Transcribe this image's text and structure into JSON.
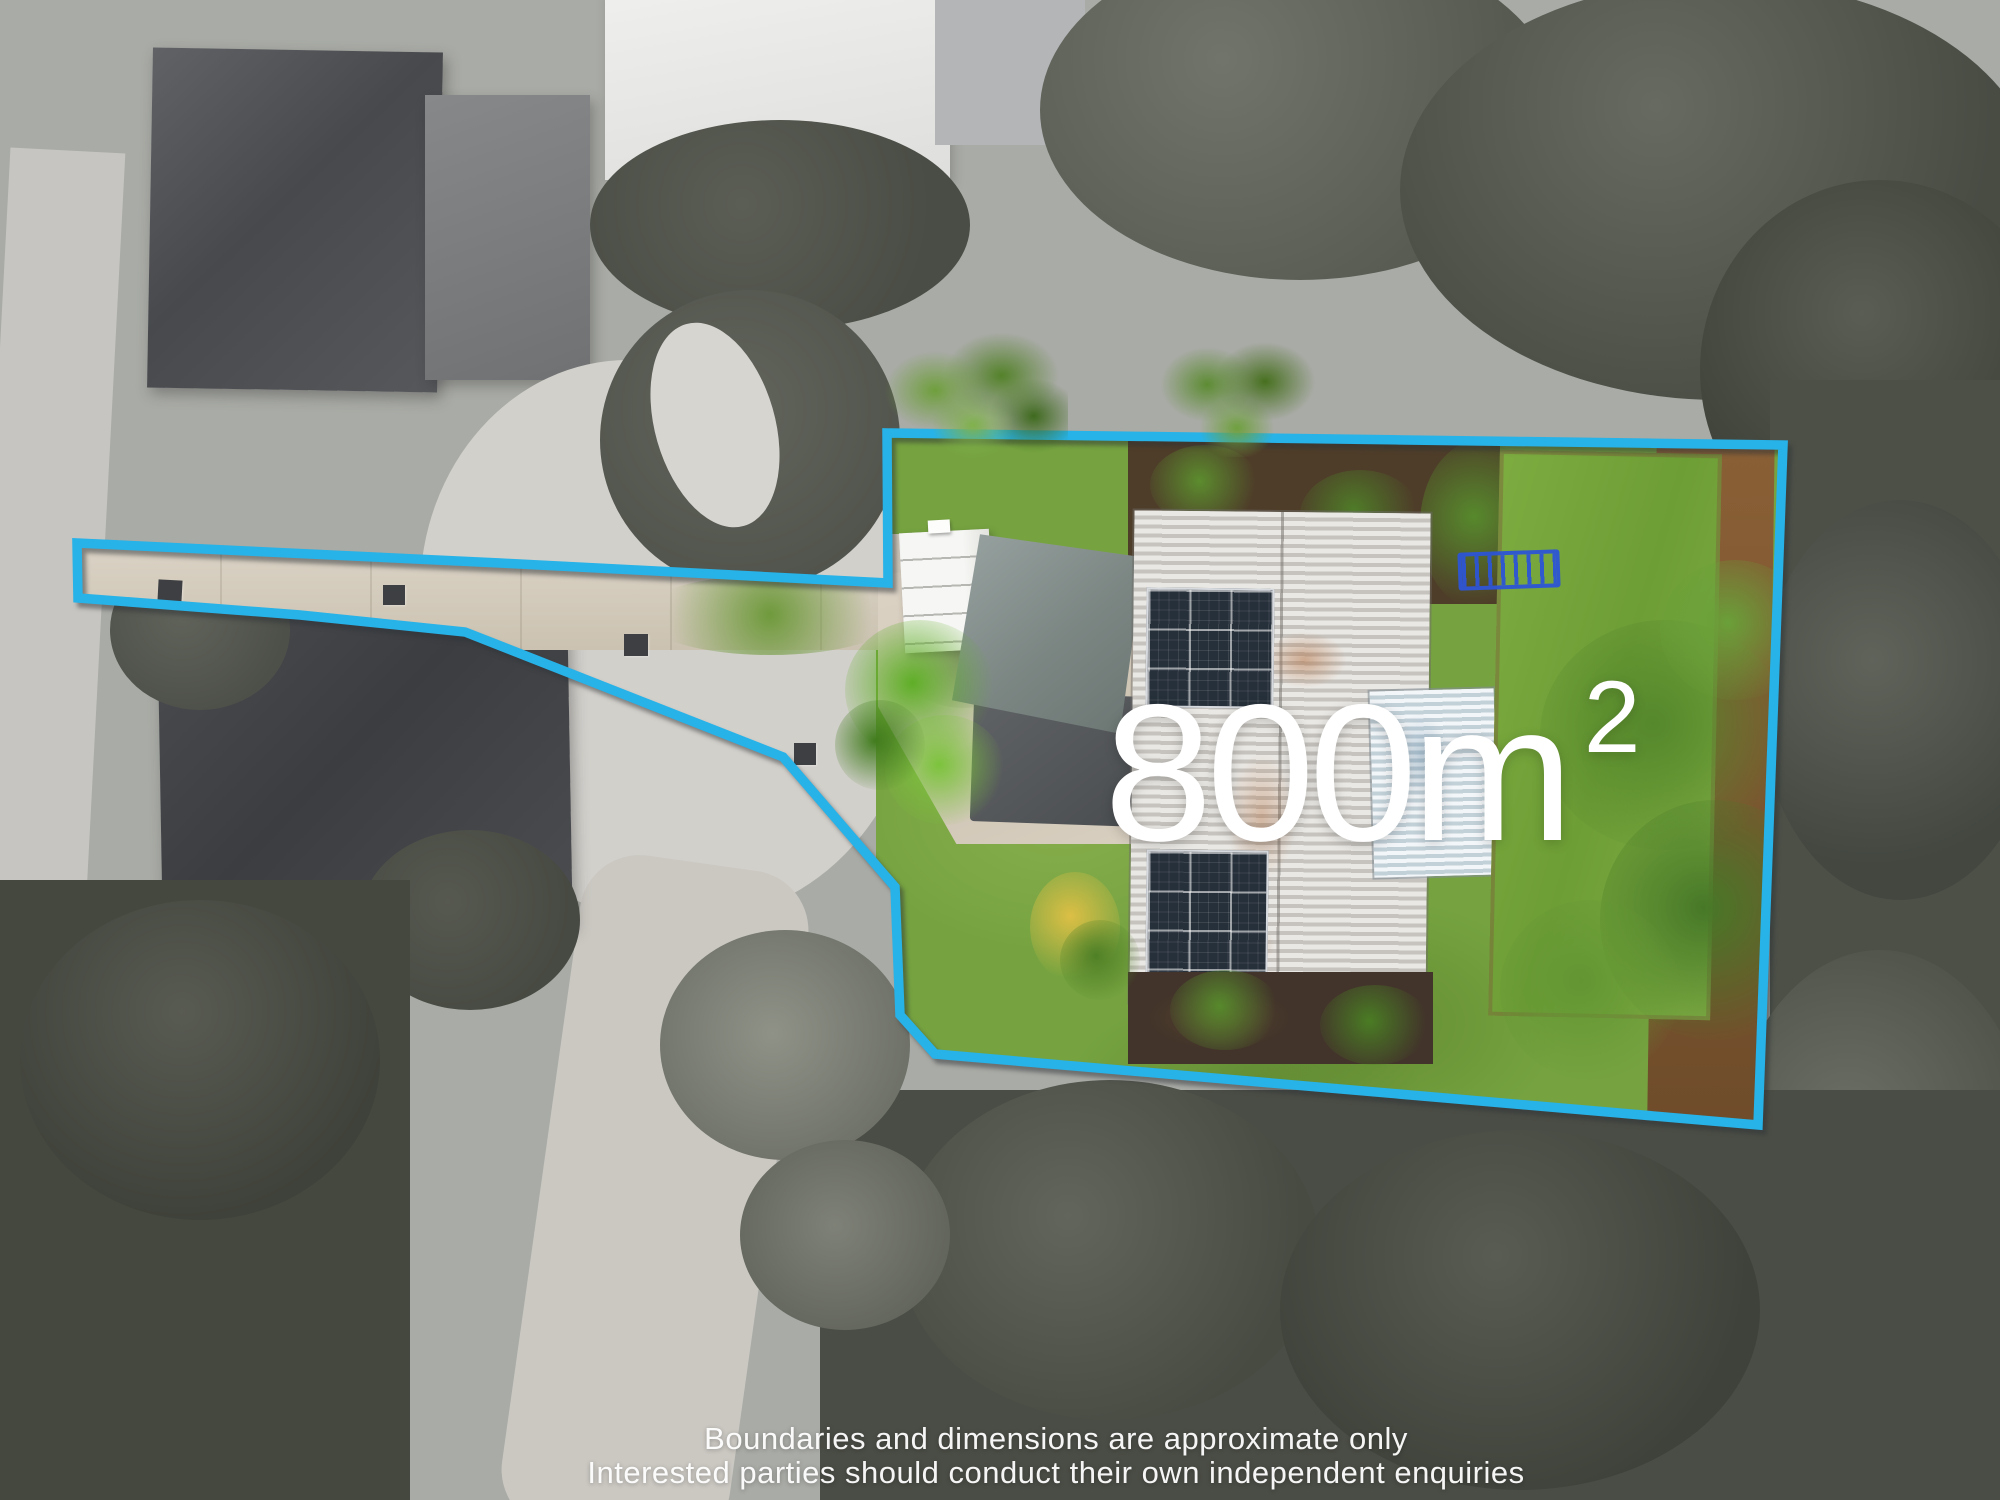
{
  "overlay": {
    "area": {
      "number": "800",
      "unit": "m",
      "exponent": "2"
    },
    "disclaimer": {
      "line1": "Boundaries and dimensions are approximate only",
      "line2": "Interested parties should conduct their own independent enquiries"
    },
    "boundary_color": "#27b2e8",
    "text_color": "#ffffff",
    "boundary_points": "77,543 500,563 888,583 887,433 1783,445 1758,1125 935,1054 900,1015 895,887 783,757 465,632 300,615 78,598"
  }
}
